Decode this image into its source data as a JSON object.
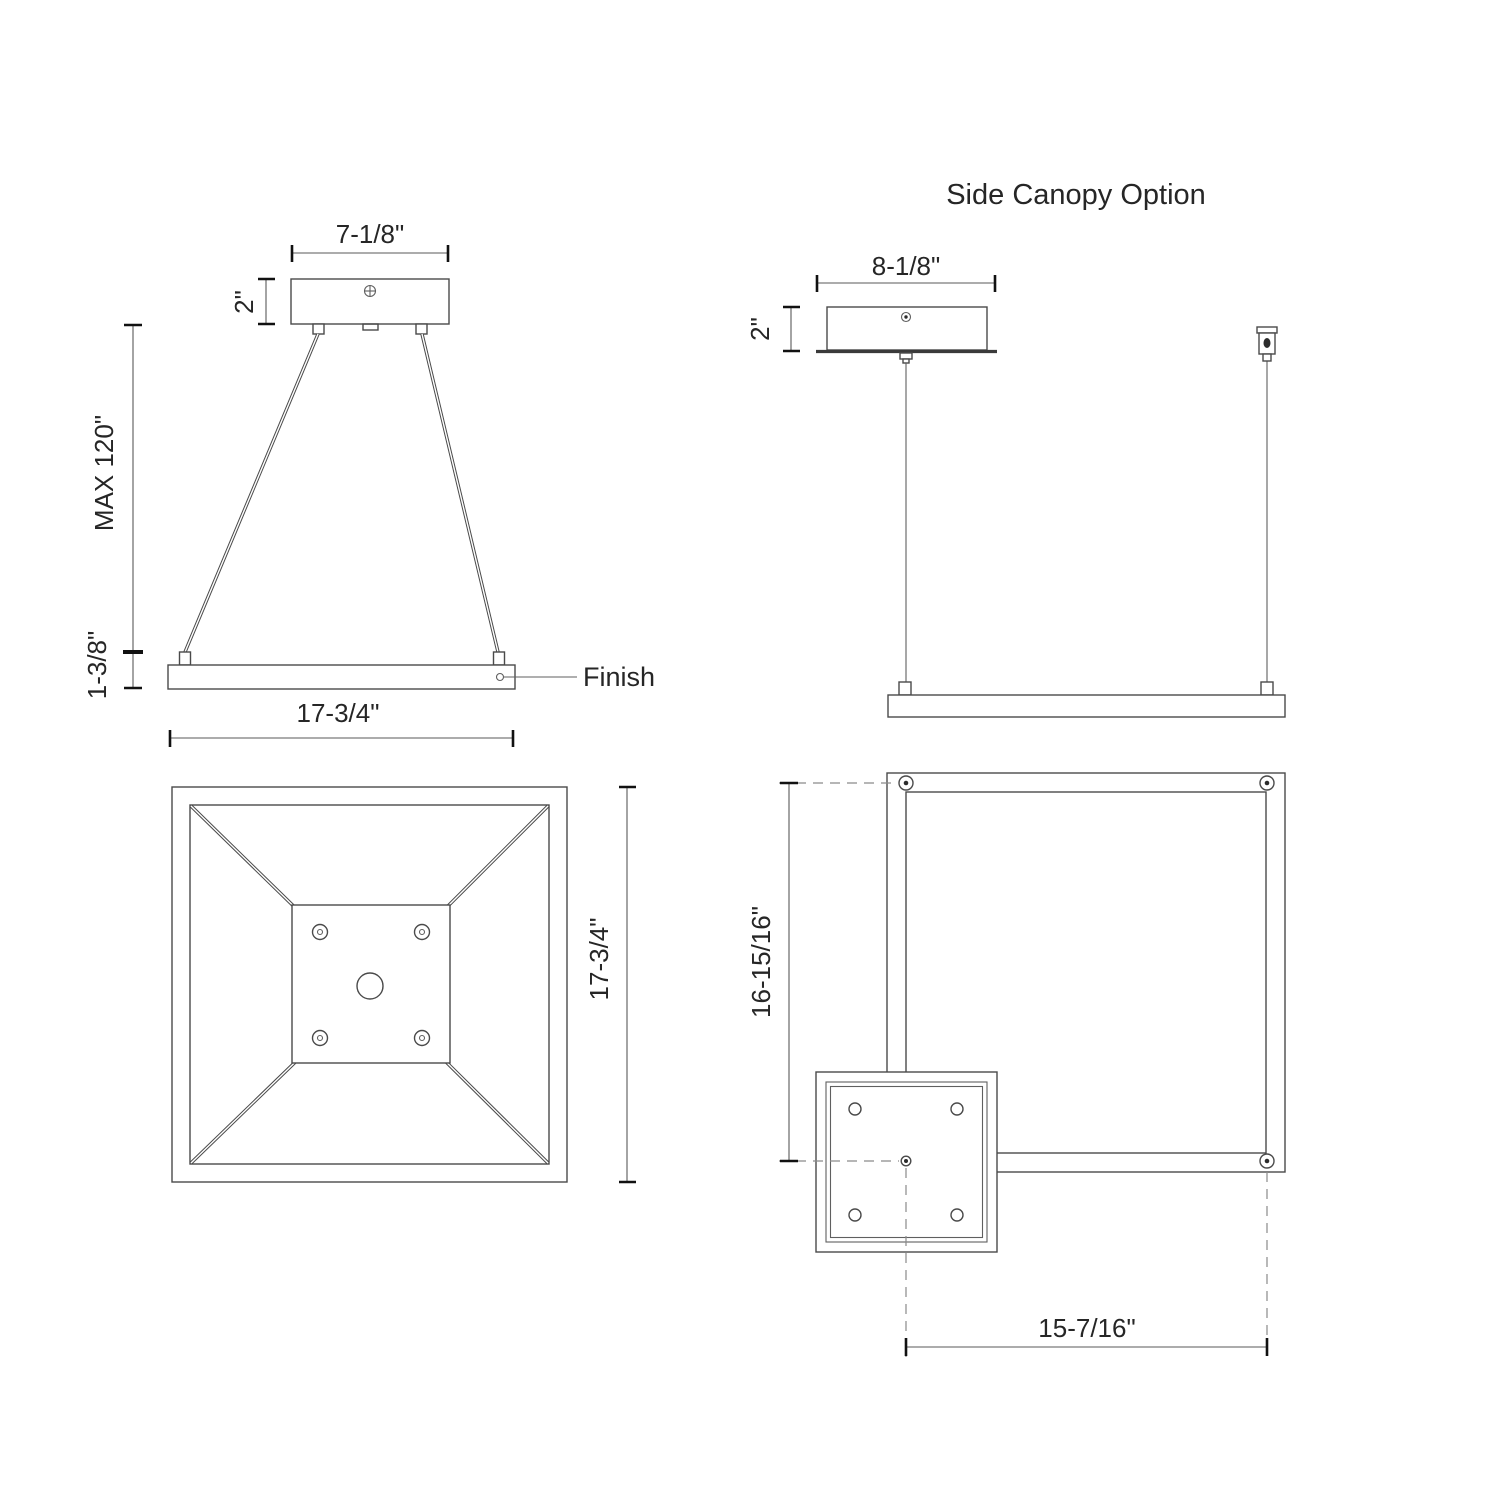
{
  "drawing": {
    "title": "Side Canopy Option",
    "labels": {
      "finish": "Finish"
    },
    "front_view": {
      "canopy_width": "7-1/8\"",
      "canopy_height": "2\"",
      "max_suspension": "MAX 120\"",
      "fixture_thickness": "1-3/8\"",
      "fixture_width": "17-3/4\""
    },
    "plan_view": {
      "fixture_depth": "17-3/4\""
    },
    "side_canopy_front_view": {
      "canopy_width": "8-1/8\"",
      "canopy_height": "2\""
    },
    "side_canopy_plan_view": {
      "vertical_offset": "16-15/16\"",
      "horizontal_offset": "15-7/16\""
    }
  }
}
